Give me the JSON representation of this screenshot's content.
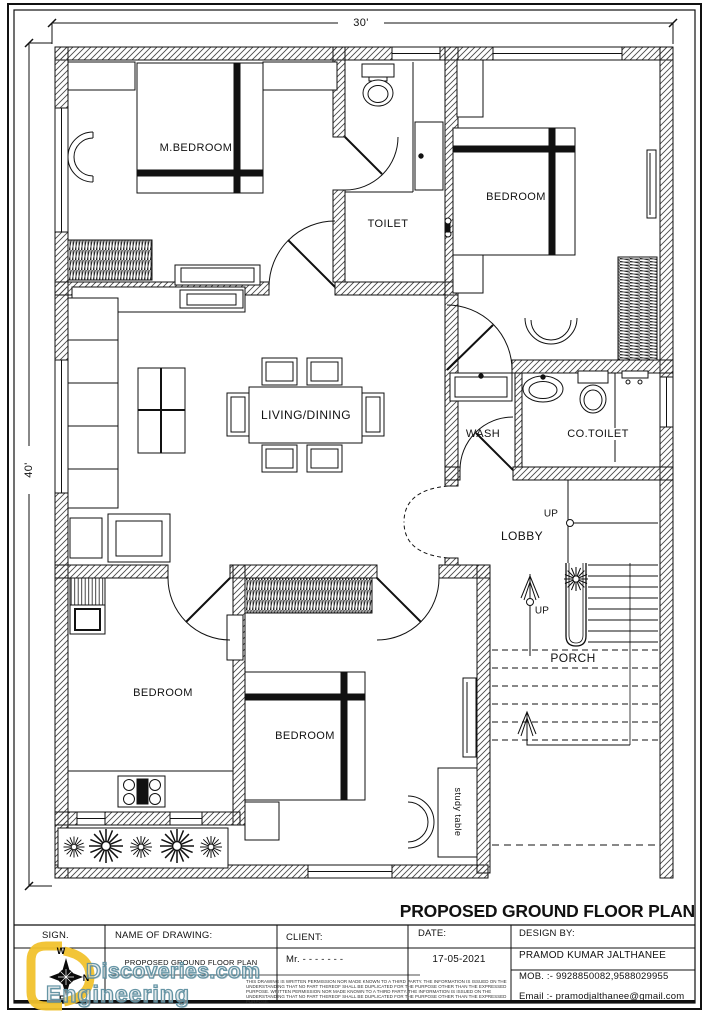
{
  "page": {
    "title": "PROPOSED GROUND FLOOR PLAN"
  },
  "dimensions": {
    "top": "30'",
    "left": "40'"
  },
  "rooms": {
    "m_bedroom": "M.BEDROOM",
    "toilet": "TOILET",
    "bedroom_top_right": "BEDROOM",
    "living_dining": "LIVING/DINING",
    "wash": "WASH",
    "co_toilet": "CO.TOILET",
    "lobby": "LOBBY",
    "porch": "PORCH",
    "bedroom_bottom_left": "BEDROOM",
    "bedroom_bottom_middle": "BEDROOM",
    "study_table": "study table",
    "up_lobby": "UP",
    "up_stairs": "UP"
  },
  "title_block": {
    "sign_label": "SIGN.",
    "name_of_drawing_label": "NAME OF DRAWING:",
    "client_label": "CLIENT:",
    "date_label": "DATE:",
    "design_by_label": "DESIGN BY:",
    "drawing_name": "PROPOSED GROUND FLOOR PLAN",
    "client_value": "Mr. - - - - - - -",
    "date_value": "17-05-2021",
    "designer_name": "PRAMOD KUMAR JALTHANEE",
    "designer_mobile": "MOB. :- 9928850082,9588029955",
    "designer_email": "Email :- pramodjalthanee@gmail.com",
    "disclaimer": "THIS DRAWING IS WRITTEN PERMISSION NOR MADE KNOWN TO A THIRD PARTY. THE INFORMATION IS ISSUED ON THE UNDERSTANDING THAT NO PART THEREOF SHALL BE DUPLICATED FOR THE PURPOSE OTHER THAN THE EXPRESSED PURPOSE. WRITTEN PERMISSION NOR MADE KNOWN TO A THIRD PARTY. THE INFORMATION IS ISSUED ON THE UNDERSTANDING THAT NO PART THEREOF SHALL BE DUPLICATED FOR THE PURPOSE OTHER THAN THE EXPRESSED PURPOSE."
  },
  "watermark": {
    "word_top": "Discoveries.com",
    "word_bottom": "Engineering",
    "compass_w": "W",
    "compass_n": "N",
    "compass_e": "E"
  },
  "colors": {
    "line": "#1a1a1a",
    "hatch": "#4a4a4a",
    "accent-yellow": "#f2c22e",
    "watermark-teal": "#5e8fa0"
  }
}
